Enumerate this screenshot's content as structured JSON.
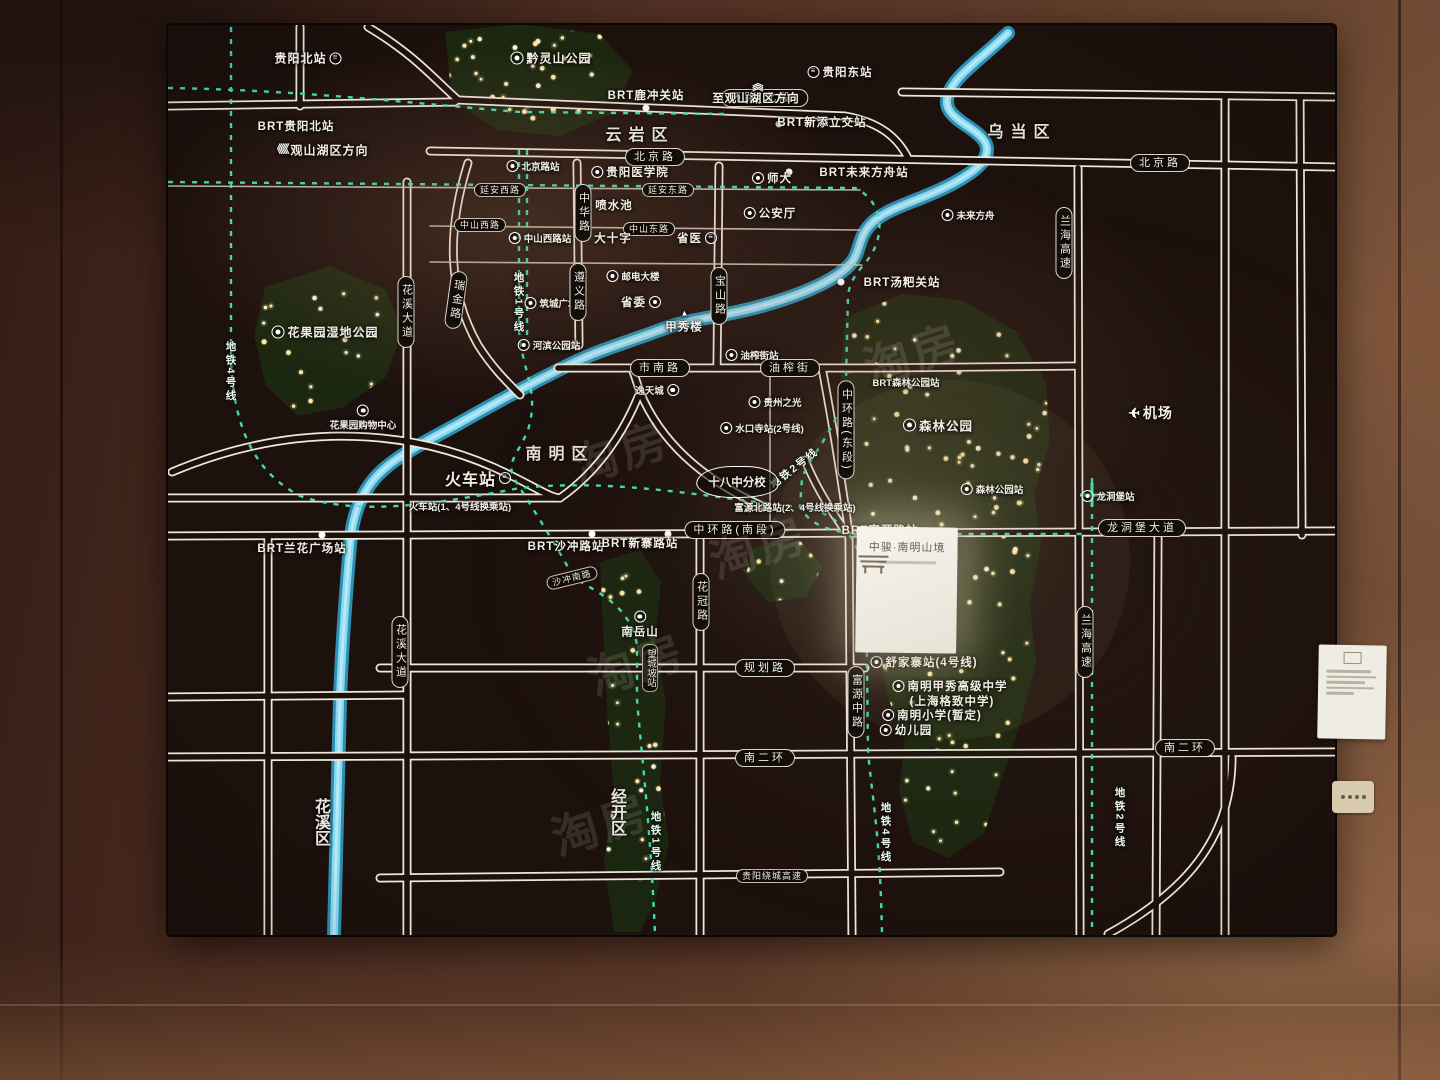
{
  "scene": {
    "description": "照片：售楼处发光区位沙盘地图（贵阳）",
    "watermark_text": "淘房"
  },
  "colors": {
    "river": "#8edcf2",
    "metro_line": "#45e6b6",
    "road": "#efe8da",
    "tree": "#1c2710",
    "tree_light": "#ffe9ac",
    "board": "#1d110d",
    "wall": "#64402c",
    "card": "#f3efe7"
  },
  "project": {
    "name": "中骏·南明山境"
  },
  "legend_lines": [
    "地铁1号线",
    "地铁2号线",
    "地铁4号线"
  ],
  "districts": [
    "云岩区",
    "乌当区",
    "南明区",
    "花溪区",
    "经开区"
  ],
  "labels": [
    {
      "t": "贵阳北站",
      "x": 308,
      "y": 58,
      "k": "s",
      "i": "rail-r",
      "fs": 12
    },
    {
      "t": "BRT贵阳北站",
      "x": 296,
      "y": 126,
      "k": "s"
    },
    {
      "t": "观山湖区方向",
      "x": 320,
      "y": 150,
      "k": "s",
      "i": "chevl-l",
      "fs": 12
    },
    {
      "t": "黔灵山公园",
      "x": 551,
      "y": 58,
      "k": "s",
      "i": "park-l",
      "fs": 12
    },
    {
      "t": "环路(北段)",
      "x": 765,
      "y": 98,
      "k": "p"
    },
    {
      "t": "BRT鹿冲关站",
      "x": 646,
      "y": 95,
      "k": "s"
    },
    {
      "t": "至观山湖区方向",
      "x": 756,
      "y": 92,
      "k": "s",
      "i": "chevu-a"
    },
    {
      "t": "贵阳东站",
      "x": 840,
      "y": 72,
      "k": "s",
      "i": "rail-l"
    },
    {
      "t": "BRT新添立交站",
      "x": 822,
      "y": 122,
      "k": "s"
    },
    {
      "t": "云岩区",
      "x": 640,
      "y": 133,
      "k": "a"
    },
    {
      "t": "乌当区",
      "x": 1022,
      "y": 130,
      "k": "a"
    },
    {
      "t": "北京路",
      "x": 655,
      "y": 157,
      "k": "p"
    },
    {
      "t": "北京路",
      "x": 1160,
      "y": 163,
      "k": "p"
    },
    {
      "t": "北京路站",
      "x": 533,
      "y": 166,
      "k": "ss",
      "i": "metro-l"
    },
    {
      "t": "贵阳医学院",
      "x": 630,
      "y": 172,
      "k": "s",
      "i": "metro-l"
    },
    {
      "t": "师大",
      "x": 772,
      "y": 178,
      "k": "s",
      "i": "metro-l"
    },
    {
      "t": "BRT未来方舟站",
      "x": 864,
      "y": 172,
      "k": "s"
    },
    {
      "t": "未来方舟",
      "x": 968,
      "y": 215,
      "k": "ss",
      "i": "metro-l"
    },
    {
      "t": "延安西路",
      "x": 500,
      "y": 190,
      "k": "ps"
    },
    {
      "t": "延安东路",
      "x": 668,
      "y": 190,
      "k": "ps"
    },
    {
      "t": "中华路",
      "x": 583,
      "y": 213,
      "k": "pv"
    },
    {
      "t": "喷水池",
      "x": 614,
      "y": 205,
      "k": "s"
    },
    {
      "t": "公安厅",
      "x": 770,
      "y": 213,
      "k": "s",
      "i": "metro-l"
    },
    {
      "t": "中山西路",
      "x": 480,
      "y": 225,
      "k": "ps"
    },
    {
      "t": "中山东路",
      "x": 649,
      "y": 229,
      "k": "ps"
    },
    {
      "t": "中山西路站",
      "x": 540,
      "y": 238,
      "k": "ss",
      "i": "metro-l"
    },
    {
      "t": "大十字",
      "x": 613,
      "y": 238,
      "k": "s"
    },
    {
      "t": "省医",
      "x": 697,
      "y": 238,
      "k": "s",
      "i": "rail-r"
    },
    {
      "t": "邮电大楼",
      "x": 633,
      "y": 276,
      "k": "ss",
      "i": "dot-l"
    },
    {
      "t": "省委",
      "x": 641,
      "y": 302,
      "k": "s",
      "i": "metro-r"
    },
    {
      "t": "甲秀楼",
      "x": 684,
      "y": 322,
      "k": "s",
      "i": "pagoda-a"
    },
    {
      "t": "筑城广场",
      "x": 551,
      "y": 303,
      "k": "ss",
      "i": "metro-l"
    },
    {
      "t": "遵义路",
      "x": 578,
      "y": 292,
      "k": "pv"
    },
    {
      "t": "瑞金路",
      "x": 456,
      "y": 300,
      "k": "pv",
      "r": 8
    },
    {
      "t": "花溪大道",
      "x": 406,
      "y": 312,
      "k": "pv"
    },
    {
      "t": "宝山路",
      "x": 719,
      "y": 296,
      "k": "pv"
    },
    {
      "t": "地铁1号线",
      "x": 519,
      "y": 303,
      "k": "mv"
    },
    {
      "t": "地铁4号线",
      "x": 231,
      "y": 372,
      "k": "mv"
    },
    {
      "t": "河滨公园站",
      "x": 549,
      "y": 345,
      "k": "ss",
      "i": "metro-l"
    },
    {
      "t": "BRT汤粑关站",
      "x": 902,
      "y": 282,
      "k": "s"
    },
    {
      "t": "市南路",
      "x": 660,
      "y": 368,
      "k": "p"
    },
    {
      "t": "油榨街",
      "x": 790,
      "y": 368,
      "k": "p"
    },
    {
      "t": "油榨街站",
      "x": 752,
      "y": 355,
      "k": "ss",
      "i": "metro-l"
    },
    {
      "t": "逸天城",
      "x": 657,
      "y": 390,
      "k": "ss",
      "i": "dot-r"
    },
    {
      "t": "贵州之光",
      "x": 775,
      "y": 402,
      "k": "ss",
      "i": "dot-l"
    },
    {
      "t": "花果园湿地公园",
      "x": 325,
      "y": 332,
      "k": "s",
      "i": "park-l",
      "fs": 12
    },
    {
      "t": "花果园购物中心",
      "x": 363,
      "y": 418,
      "k": "ss",
      "i": "dot-a"
    },
    {
      "t": "森林公园",
      "x": 938,
      "y": 425,
      "k": "s",
      "i": "park-l",
      "fs": 12.5
    },
    {
      "t": "BRT森林公园站",
      "x": 906,
      "y": 382,
      "k": "ss"
    },
    {
      "t": "机场",
      "x": 1150,
      "y": 413,
      "k": "s",
      "i": "plane-l",
      "fs": 14
    },
    {
      "t": "水口寺站(2号线)",
      "x": 762,
      "y": 428,
      "k": "ss",
      "i": "metro-l"
    },
    {
      "t": "中环路(东段)",
      "x": 846,
      "y": 430,
      "k": "pv"
    },
    {
      "t": "地铁2号线",
      "x": 794,
      "y": 468,
      "k": "m",
      "r": -38
    },
    {
      "t": "南明区",
      "x": 560,
      "y": 452,
      "k": "a"
    },
    {
      "t": "火车站",
      "x": 478,
      "y": 478,
      "k": "s",
      "i": "rail-r",
      "fs": 16
    },
    {
      "t": "火车站(1、4号线换乘站)",
      "x": 460,
      "y": 506,
      "k": "ss"
    },
    {
      "t": "十八中分校",
      "x": 737,
      "y": 482,
      "k": "cloud"
    },
    {
      "t": "富源北路站(2、4号线换乘站)",
      "x": 795,
      "y": 507,
      "k": "ss"
    },
    {
      "t": "森林公园站",
      "x": 992,
      "y": 489,
      "k": "ss",
      "i": "metro-l"
    },
    {
      "t": "龙洞堡站",
      "x": 1108,
      "y": 496,
      "k": "ss",
      "i": "metro-l"
    },
    {
      "t": "龙洞堡大道",
      "x": 1142,
      "y": 528,
      "k": "p"
    },
    {
      "t": "兰海高速",
      "x": 1064,
      "y": 243,
      "k": "pv"
    },
    {
      "t": "兰海高速",
      "x": 1085,
      "y": 642,
      "k": "pv"
    },
    {
      "t": "BRT兰花广场站",
      "x": 302,
      "y": 548,
      "k": "s"
    },
    {
      "t": "BRT沙冲路站",
      "x": 566,
      "y": 546,
      "k": "s"
    },
    {
      "t": "BRT新寨路站",
      "x": 640,
      "y": 543,
      "k": "s"
    },
    {
      "t": "中环路(南段)",
      "x": 735,
      "y": 530,
      "k": "p"
    },
    {
      "t": "BRT富源路站",
      "x": 880,
      "y": 530,
      "k": "s"
    },
    {
      "t": "沙冲南路",
      "x": 572,
      "y": 578,
      "k": "ps",
      "r": -14
    },
    {
      "t": "花冠路",
      "x": 701,
      "y": 602,
      "k": "pv"
    },
    {
      "t": "南岳山",
      "x": 640,
      "y": 625,
      "k": "s",
      "i": "metro-a"
    },
    {
      "t": "望城坡站",
      "x": 650,
      "y": 668,
      "k": "ssv"
    },
    {
      "t": "规划路",
      "x": 765,
      "y": 668,
      "k": "p"
    },
    {
      "t": "富源中路",
      "x": 856,
      "y": 702,
      "k": "pv"
    },
    {
      "t": "舒家寨站(4号线)",
      "x": 924,
      "y": 662,
      "k": "s",
      "i": "metro-l"
    },
    {
      "t": "南明甲秀高级中学",
      "x": 950,
      "y": 686,
      "k": "s",
      "i": "dot-l"
    },
    {
      "t": "(上海格致中学)",
      "x": 952,
      "y": 701,
      "k": "s"
    },
    {
      "t": "南明小学(暂定)",
      "x": 932,
      "y": 715,
      "k": "s",
      "i": "dot-l"
    },
    {
      "t": "幼儿园",
      "x": 906,
      "y": 730,
      "k": "s",
      "i": "dot-l"
    },
    {
      "t": "南二环",
      "x": 765,
      "y": 758,
      "k": "p"
    },
    {
      "t": "南二环",
      "x": 1185,
      "y": 748,
      "k": "p"
    },
    {
      "t": "经开区",
      "x": 616,
      "y": 812,
      "k": "av"
    },
    {
      "t": "花溪区",
      "x": 320,
      "y": 822,
      "k": "av"
    },
    {
      "t": "花溪大道",
      "x": 400,
      "y": 652,
      "k": "pv"
    },
    {
      "t": "地铁1号线",
      "x": 656,
      "y": 842,
      "k": "mv"
    },
    {
      "t": "地铁4号线",
      "x": 886,
      "y": 833,
      "k": "mv"
    },
    {
      "t": "地铁2号线",
      "x": 1120,
      "y": 818,
      "k": "mv"
    },
    {
      "t": "贵阳绕城高速",
      "x": 772,
      "y": 876,
      "k": "ps"
    }
  ],
  "watermarks": [
    {
      "x": 620,
      "y": 450
    },
    {
      "x": 758,
      "y": 545
    },
    {
      "x": 636,
      "y": 662
    },
    {
      "x": 912,
      "y": 352
    },
    {
      "x": 600,
      "y": 822
    }
  ]
}
